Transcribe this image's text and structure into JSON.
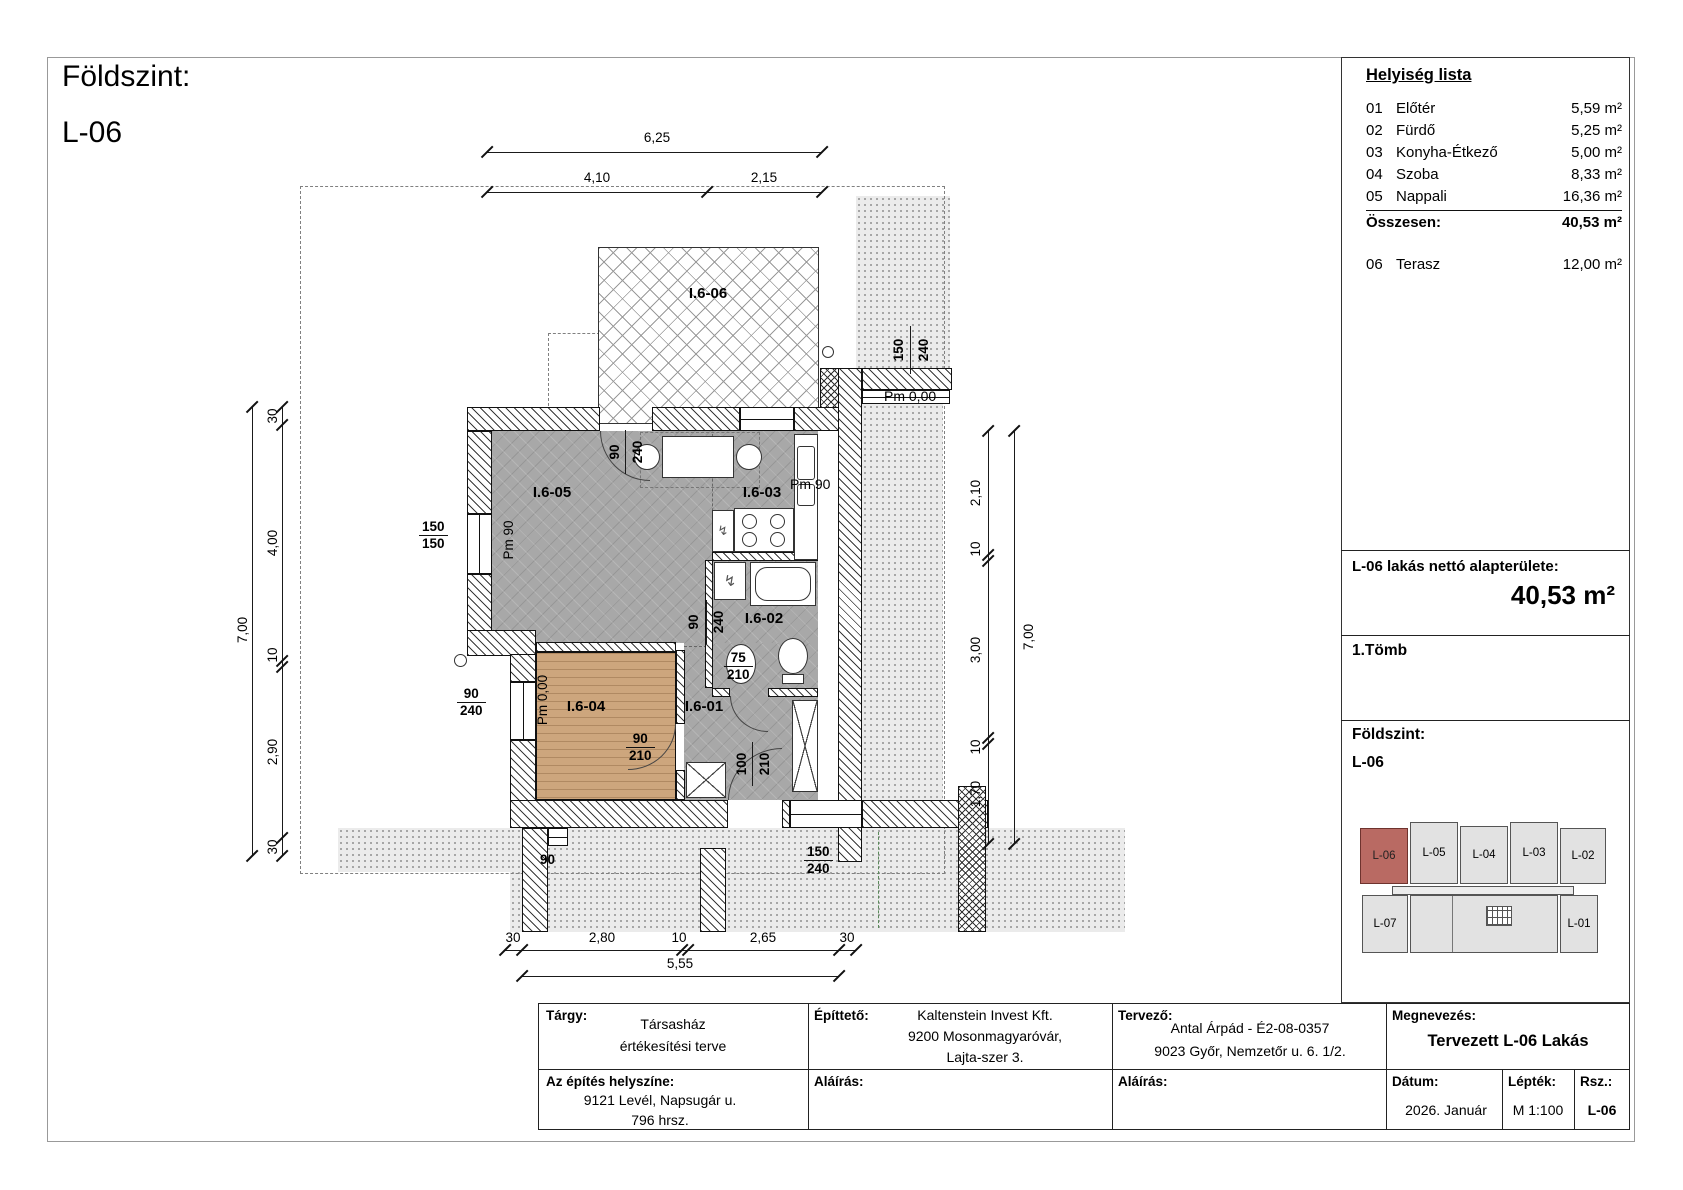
{
  "sheet": {
    "title1": "Földszint:",
    "title2": "L-06"
  },
  "room_list": {
    "heading": "Helyiség lista",
    "rows": [
      {
        "num": "01",
        "name": "Előtér",
        "area": "5,59 m²"
      },
      {
        "num": "02",
        "name": "Fürdő",
        "area": "5,25 m²"
      },
      {
        "num": "03",
        "name": "Konyha-Étkező",
        "area": "5,00 m²"
      },
      {
        "num": "04",
        "name": "Szoba",
        "area": "8,33 m²"
      },
      {
        "num": "05",
        "name": "Nappali",
        "area": "16,36 m²"
      }
    ],
    "total_label": "Összesen:",
    "total_area": "40,53 m²",
    "terasz": {
      "num": "06",
      "name": "Terasz",
      "area": "12,00 m²"
    }
  },
  "net_area": {
    "label": "L-06 lakás nettó alapterülete:",
    "value": "40,53 m²"
  },
  "block_label": "1.Tömb",
  "floor_section": {
    "line1": "Földszint:",
    "line2": "L-06"
  },
  "key_plan": {
    "units_top": [
      "L-06",
      "L-05",
      "L-04",
      "L-03",
      "L-02"
    ],
    "unit_bottom_left": "L-07",
    "unit_bottom_right": "L-01",
    "highlight_unit": "L-06",
    "highlight_color": "#b96a63"
  },
  "title_block": {
    "targy_label": "Tárgy:",
    "targy_l1": "Társasház",
    "targy_l2": "értékesítési terve",
    "epitteto_label": "Építtető:",
    "epitteto_l1": "Kaltenstein Invest Kft.",
    "epitteto_l2": "9200 Mosonmagyaróvár,",
    "epitteto_l3": "Lajta-szer 3.",
    "tervezo_label": "Tervező:",
    "tervezo_l1": "Antal Árpád - É2-08-0357",
    "tervezo_l2": "9023 Győr, Nemzetőr u. 6. 1/2.",
    "megnevezes_label": "Megnevezés:",
    "megnevezes_value": "Tervezett L-06 Lakás",
    "helyszin_label": "Az építés helyszíne:",
    "helyszin_l1": "9121 Levél, Napsugár u.",
    "helyszin_l2": "796 hrsz.",
    "alairas_label": "Aláírás:",
    "datum_label": "Dátum:",
    "datum_value": "2026. Január",
    "leptek_label": "Lépték:",
    "leptek_value": "M 1:100",
    "rsz_label": "Rsz.:",
    "rsz_value": "L-06"
  },
  "plan": {
    "room_codes": {
      "terrace": "I.6-06",
      "living": "I.6-05",
      "kitchen": "I.6-03",
      "bath": "I.6-02",
      "bedroom": "I.6-04",
      "hall": "I.6-01"
    },
    "dims": {
      "top_total": "6,25",
      "top_a": "4,10",
      "top_b": "2,15",
      "left_a": "30",
      "left_b": "4,00",
      "left_c": "10",
      "left_d": "2,90",
      "left_e": "30",
      "left_total": "7,00",
      "right_a": "2,10",
      "right_b": "10",
      "right_c": "3,00",
      "right_d": "10",
      "right_e": "1,70",
      "right_total": "7,00",
      "bot_a": "30",
      "bot_b": "2,80",
      "bot_c": "10",
      "bot_d": "2,65",
      "bot_e": "30",
      "bot_total": "5,55"
    },
    "openings": {
      "terr_w": "90",
      "terr_h": "240",
      "kitchen_level": "Pm 90",
      "left_win_w": "150",
      "left_win_h": "150",
      "living_level": "Pm 90",
      "pass_w": "90",
      "pass_h": "240",
      "bath_door_w": "75",
      "bath_door_h": "210",
      "bed_win_w": "90",
      "bed_win_h": "240",
      "bed_level": "Pm 0,00",
      "bed_door_w": "90",
      "bed_door_h": "210",
      "entry_w": "100",
      "entry_h": "210",
      "bot_win_w": "150",
      "bot_win_h": "240",
      "tr_win_w": "150",
      "tr_win_h": "240",
      "terrain_level": "Pm 0,00",
      "small_win": "90"
    }
  }
}
